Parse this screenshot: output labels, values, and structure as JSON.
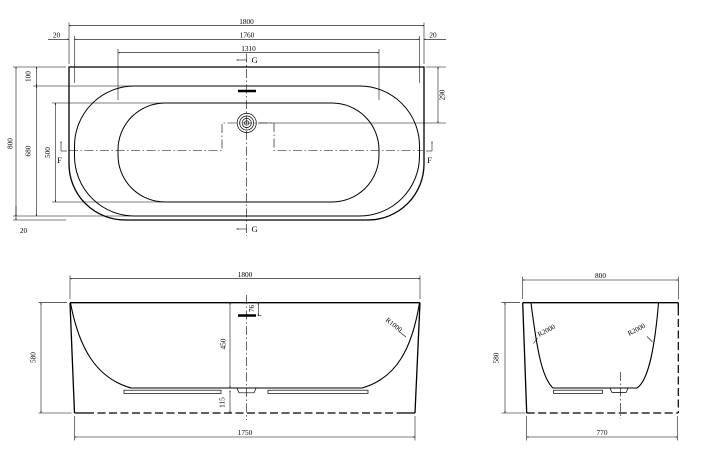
{
  "plan_view": {
    "dim_overall_length": "1800",
    "dim_rim_length": "1760",
    "dim_basin_length": "1310",
    "dim_gap_left": "20",
    "dim_gap_right": "20",
    "dim_overall_width": "800",
    "dim_rim_width": "680",
    "dim_basin_width": "500",
    "dim_rim_top_offset": "100",
    "dim_gap_bottom": "20",
    "dim_drain_from_back": "290",
    "section_g": "G",
    "section_f": "F"
  },
  "front_view": {
    "dim_overall_length": "1800",
    "dim_height": "580",
    "dim_base_length": "1750",
    "dim_inner_depth": "450",
    "dim_overflow_offset": "76",
    "dim_base_height": "115",
    "dim_wall_radius": "R1000"
  },
  "side_view": {
    "dim_overall_width": "800",
    "dim_height": "580",
    "dim_base_width": "770",
    "dim_radius_left": "R2000",
    "dim_radius_right": "R2000"
  }
}
